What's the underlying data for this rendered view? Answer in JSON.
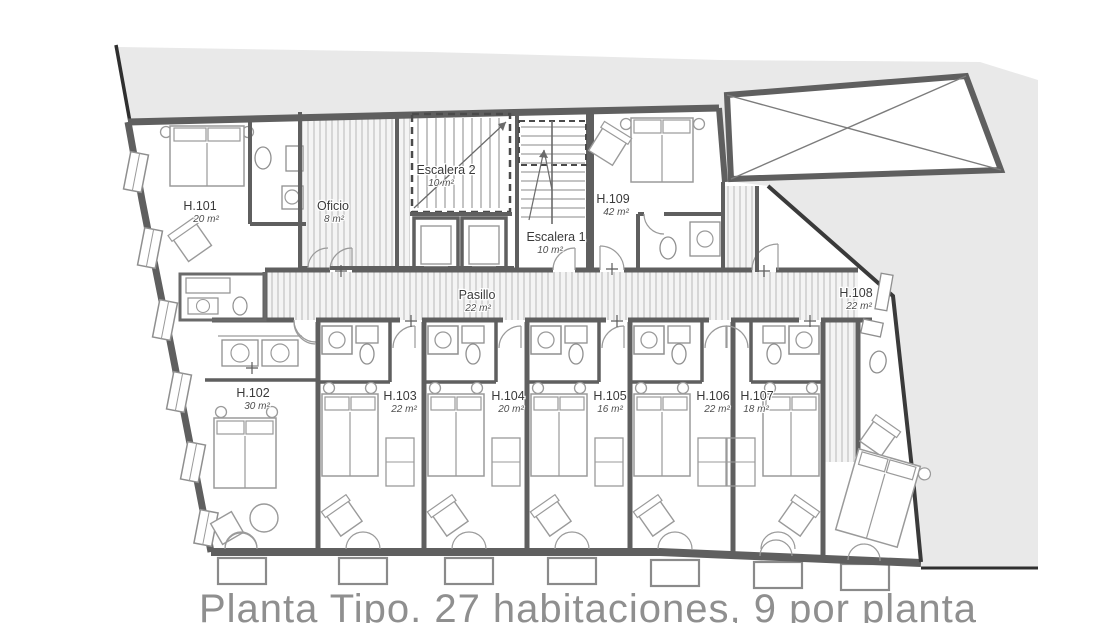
{
  "caption": "Planta Tipo. 27 habitaciones, 9 por planta",
  "rooms": [
    {
      "label": "H.101",
      "area": "20 m²"
    },
    {
      "label": "H.102",
      "area": "30 m²"
    },
    {
      "label": "H.103",
      "area": "22 m²"
    },
    {
      "label": "H.104",
      "area": "20 m²"
    },
    {
      "label": "H.105",
      "area": "16 m²"
    },
    {
      "label": "H.106",
      "area": "22 m²"
    },
    {
      "label": "H.107",
      "area": "18 m²"
    },
    {
      "label": "H.108",
      "area": "22 m²"
    },
    {
      "label": "H.109",
      "area": "42 m²"
    }
  ],
  "service_spaces": [
    {
      "label": "Oficio",
      "area": "8 m²"
    },
    {
      "label": "Escalera 2",
      "area": "10 m²"
    },
    {
      "label": "Escalera 1",
      "area": "10 m²"
    },
    {
      "label": "Pasillo",
      "area": "22 m²"
    }
  ],
  "colors": {
    "exterior_ground": "#e9e9e9",
    "walls": "#5f5f5f",
    "site_boundary": "#2f2f2f",
    "furniture_lines": "#9a9a9a",
    "hatch_lines": "#d6d6d6",
    "label_text": "#3a3a3a",
    "area_text": "#4f4f4f",
    "caption_text": "#8f8f8f"
  }
}
